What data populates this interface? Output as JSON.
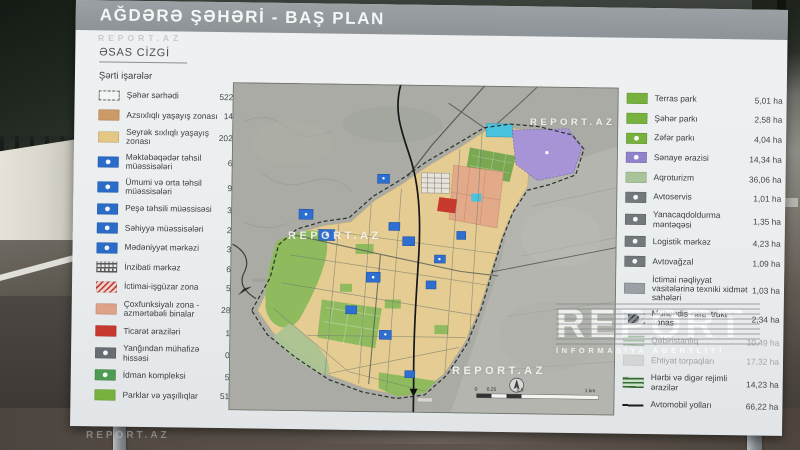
{
  "sign": {
    "title": "AĞDƏRƏ ŞƏHƏRİ - BAŞ PLAN",
    "subtitle": "ƏSAS CİZGİ",
    "legend_left": {
      "header": "Şərti işarələr",
      "items": [
        {
          "label": "Şəhər sərhədi",
          "value": "522,18 ha",
          "swatch": {
            "kind": "dashed"
          }
        },
        {
          "label": "Azsıxlıqlı yaşayış zonası",
          "value": "14,79 ha",
          "swatch": {
            "kind": "fill",
            "color": "#cc9a66"
          }
        },
        {
          "label": "Seyrək sıxlıqlı yaşayış zonası",
          "value": "202,25 ha",
          "swatch": {
            "kind": "fill",
            "color": "#e5c785"
          }
        },
        {
          "label": "Məktəbəqədər təhsil müəssisələri",
          "value": "6,59 ha",
          "swatch": {
            "kind": "icon",
            "color": "#2a6cc8"
          }
        },
        {
          "label": "Ümumi və orta təhsil müəssisələri",
          "value": "9,06 ha",
          "swatch": {
            "kind": "icon",
            "color": "#2a6cc8"
          }
        },
        {
          "label": "Peşə təhsili müəssisəsi",
          "value": "3,29 ha",
          "swatch": {
            "kind": "icon",
            "color": "#2a6cc8"
          }
        },
        {
          "label": "Səhiyyə müəssisələri",
          "value": "2,04 ha",
          "swatch": {
            "kind": "icon",
            "color": "#2a6cc8"
          }
        },
        {
          "label": "Mədəniyyət mərkəzi",
          "value": "3,06 ha",
          "swatch": {
            "kind": "icon",
            "color": "#2a6cc8"
          }
        },
        {
          "label": "İnzibati mərkəz",
          "value": "6,35 ha",
          "swatch": {
            "kind": "cross",
            "stripe": "#55585c",
            "base": "#eceae4"
          }
        },
        {
          "label": "İctimai-işgüzar zona",
          "value": "5,99 ha",
          "swatch": {
            "kind": "hatch",
            "stripe": "#c2443a",
            "base": "#f0d6d2"
          }
        },
        {
          "label": "Çoxfunksiyalı zona - azmərtəbəli binalar",
          "value": "28,98 ha",
          "swatch": {
            "kind": "fill",
            "color": "#dda288"
          }
        },
        {
          "label": "Ticarət əraziləri",
          "value": "1,94 ha",
          "swatch": {
            "kind": "fill",
            "color": "#c7392f"
          }
        },
        {
          "label": "Yanğından mühafizə hissəsi",
          "value": "0,75 ha",
          "swatch": {
            "kind": "icon",
            "color": "#686d72"
          }
        },
        {
          "label": "İdman kompleksi",
          "value": "5,17 ha",
          "swatch": {
            "kind": "icon",
            "color": "#4f9b51"
          }
        },
        {
          "label": "Parklar və yaşıllıqlar",
          "value": "51,58 ha",
          "swatch": {
            "kind": "fill",
            "color": "#77b23f"
          }
        }
      ]
    },
    "legend_right": {
      "items": [
        {
          "label": "Terras park",
          "value": "5,01 ha",
          "swatch": {
            "kind": "fill",
            "color": "#77b23f"
          }
        },
        {
          "label": "Şəhər parkı",
          "value": "2,58 ha",
          "swatch": {
            "kind": "fill",
            "color": "#77b23f"
          }
        },
        {
          "label": "Zəfər parkı",
          "value": "4,04 ha",
          "swatch": {
            "kind": "icon",
            "color": "#77b23f"
          }
        },
        {
          "label": "Sənaye ərazisi",
          "value": "14,34 ha",
          "swatch": {
            "kind": "icon",
            "color": "#9183cb"
          }
        },
        {
          "label": "Aqroturizm",
          "value": "36,06 ha",
          "swatch": {
            "kind": "fill",
            "color": "#a9c498"
          }
        },
        {
          "label": "Avtoservis",
          "value": "1,01 ha",
          "swatch": {
            "kind": "icon",
            "color": "#73787c"
          }
        },
        {
          "label": "Yanacaqdoldurma məntəqəsi",
          "value": "1,35 ha",
          "swatch": {
            "kind": "icon",
            "color": "#73787c"
          }
        },
        {
          "label": "Logistik mərkəz",
          "value": "4,23 ha",
          "swatch": {
            "kind": "icon",
            "color": "#73787c"
          }
        },
        {
          "label": "Avtovağzal",
          "value": "1,09 ha",
          "swatch": {
            "kind": "icon",
            "color": "#73787c"
          }
        },
        {
          "label": "İctimai nəqliyyat vasitələrinə texniki xidmət sahələri",
          "value": "1,03 ha",
          "swatch": {
            "kind": "fill",
            "color": "#9aa0a4"
          }
        },
        {
          "label": "Mühəndis infrastruktur zonası",
          "value": "2,34 ha",
          "swatch": {
            "kind": "hatch",
            "stripe": "#3f4449",
            "base": "#8a9095"
          }
        },
        {
          "label": "Qəbiristanlıq",
          "value": "10,49 ha",
          "obscured": true,
          "swatch": {
            "kind": "hatch",
            "dir": 0,
            "stripe": "#4c8a4c",
            "base": "#dfe5da"
          }
        },
        {
          "label": "Ehtiyat torpaqları",
          "value": "17,32 ha",
          "obscured": true,
          "swatch": {
            "kind": "fill",
            "color": "#b8bdb9"
          }
        },
        {
          "label": "Hərbi və digər rejimli ərazilər",
          "value": "14,23 ha",
          "swatch": {
            "kind": "hatch",
            "dir": 0,
            "stripe": "#2f6b33",
            "base": "#cfe0c8"
          }
        },
        {
          "label": "Avtomobil yolları",
          "value": "66,22 ha",
          "swatch": {
            "kind": "line"
          }
        }
      ]
    },
    "map": {
      "scale": {
        "s0": "0",
        "s1": "0,25",
        "s2": "0,5",
        "s3": "1 km"
      }
    }
  },
  "watermarks": {
    "under_title": "REPORT.AZ",
    "map_top": "REPORT.AZ",
    "map_center": "REPORT.AZ",
    "map_bottom": "REPORT.AZ",
    "big_line1": "REPORT",
    "big_line2": "İNFORMASİYA AGENTLİYİ",
    "photo_bottom": "REPORT.AZ"
  },
  "colors": {
    "low_density_residential": "#cc9a66",
    "sparse_residential": "#e5c785",
    "facility_blue": "#2a6cc8",
    "commercial_red": "#c7392f",
    "multifunction_salmon": "#dda288",
    "park_green": "#77b23f",
    "industry_purple": "#9183cb",
    "terrain_gray": "#a9aba4"
  }
}
